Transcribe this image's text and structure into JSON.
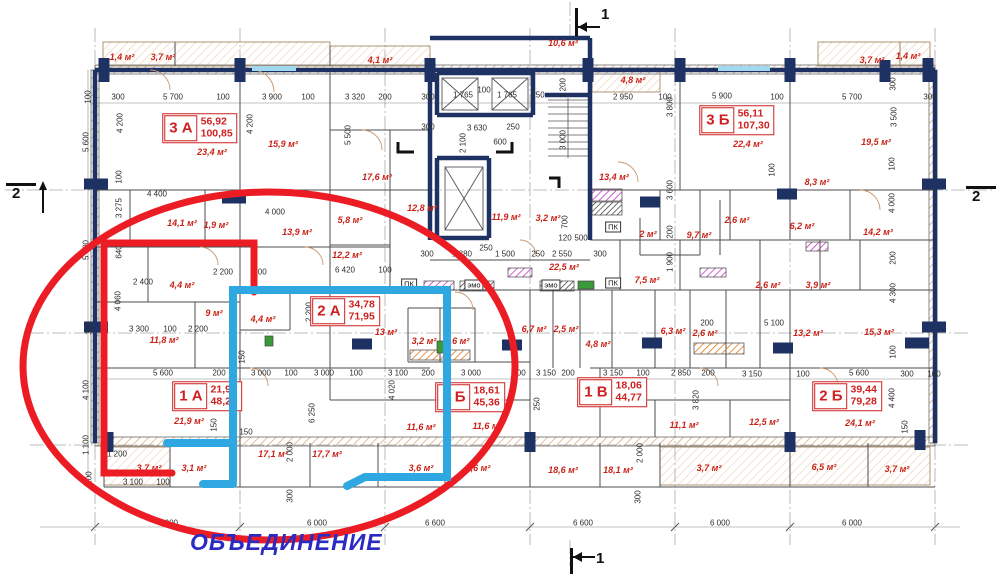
{
  "annotation": {
    "text": "ОБЪЕДИНЕНИЕ"
  },
  "colors": {
    "wall": "#1d3263",
    "area_label": "#c92318",
    "dimension": "#2b2b2b",
    "merge_ellipse": "#ec1c24",
    "merge_outline_red": "#ec1c24",
    "merge_outline_blue": "#2fa8e1",
    "annotation_text": "#2b2bc4",
    "vent_purple": "#c238c2",
    "vent_orange": "#e07818",
    "balcony_hatch": "#d8a36b"
  },
  "section_markers": [
    {
      "label": "1",
      "dir": "top",
      "x": 575,
      "y": 8
    },
    {
      "label": "1",
      "dir": "bottom",
      "x": 570,
      "y": 548
    },
    {
      "label": "2",
      "dir": "left",
      "x": 6,
      "y": 183
    },
    {
      "label": "2",
      "dir": "right",
      "x": 966,
      "y": 186
    }
  ],
  "apartments": [
    {
      "code": "3 А",
      "v1": "56,92",
      "v2": "100,85",
      "x": 200,
      "y": 128
    },
    {
      "code": "3 Б",
      "v1": "56,11",
      "v2": "107,30",
      "x": 737,
      "y": 120
    },
    {
      "code": "2 А",
      "v1": "34,78",
      "v2": "71,95",
      "x": 345,
      "y": 311
    },
    {
      "code": "1 А",
      "v1": "21,92",
      "v2": "48,23",
      "x": 207,
      "y": 396
    },
    {
      "code": "1 Б",
      "v1": "18,61",
      "v2": "45,36",
      "x": 470,
      "y": 397
    },
    {
      "code": "1 В",
      "v1": "18,06",
      "v2": "44,77",
      "x": 612,
      "y": 392
    },
    {
      "code": "2 Б",
      "v1": "39,44",
      "v2": "79,28",
      "x": 847,
      "y": 396
    }
  ],
  "room_areas": [
    {
      "t": "1,4 м²",
      "x": 122,
      "y": 57
    },
    {
      "t": "3,7 м²",
      "x": 163,
      "y": 57
    },
    {
      "t": "4,1 м²",
      "x": 380,
      "y": 60
    },
    {
      "t": "10,6 м²",
      "x": 563,
      "y": 43
    },
    {
      "t": "4,8 м²",
      "x": 633,
      "y": 80
    },
    {
      "t": "3,7 м²",
      "x": 872,
      "y": 60
    },
    {
      "t": "1,4 м²",
      "x": 908,
      "y": 56
    },
    {
      "t": "23,4 м²",
      "x": 212,
      "y": 152
    },
    {
      "t": "15,9 м²",
      "x": 283,
      "y": 144
    },
    {
      "t": "17,6 м²",
      "x": 377,
      "y": 177
    },
    {
      "t": "22,4 м²",
      "x": 748,
      "y": 144
    },
    {
      "t": "19,5 м²",
      "x": 876,
      "y": 142
    },
    {
      "t": "12,8 м²",
      "x": 422,
      "y": 208
    },
    {
      "t": "11,9 м²",
      "x": 506,
      "y": 217
    },
    {
      "t": "3,2 м²",
      "x": 548,
      "y": 218
    },
    {
      "t": "13,4 м²",
      "x": 614,
      "y": 177
    },
    {
      "t": "8,3 м²",
      "x": 817,
      "y": 182
    },
    {
      "t": "6,2 м²",
      "x": 802,
      "y": 226
    },
    {
      "t": "14,1 м²",
      "x": 182,
      "y": 223
    },
    {
      "t": "1,9 м²",
      "x": 216,
      "y": 225
    },
    {
      "t": "13,9 м²",
      "x": 297,
      "y": 232
    },
    {
      "t": "5,8 м²",
      "x": 350,
      "y": 220
    },
    {
      "t": "12,2 м²",
      "x": 347,
      "y": 255
    },
    {
      "t": "22,5 м²",
      "x": 564,
      "y": 267
    },
    {
      "t": "2 м²",
      "x": 648,
      "y": 234
    },
    {
      "t": "9,7 м²",
      "x": 699,
      "y": 235
    },
    {
      "t": "2,6 м²",
      "x": 737,
      "y": 220
    },
    {
      "t": "14,2 м²",
      "x": 878,
      "y": 232
    },
    {
      "t": "4,4 м²",
      "x": 182,
      "y": 285
    },
    {
      "t": "9 м²",
      "x": 214,
      "y": 313
    },
    {
      "t": "11,8 м²",
      "x": 164,
      "y": 340
    },
    {
      "t": "4,4 м²",
      "x": 263,
      "y": 319
    },
    {
      "t": "13 м²",
      "x": 386,
      "y": 332
    },
    {
      "t": "3,2 м²",
      "x": 424,
      "y": 341
    },
    {
      "t": "4,6 м²",
      "x": 457,
      "y": 341
    },
    {
      "t": "6,7 м²",
      "x": 534,
      "y": 329
    },
    {
      "t": "2,5 м²",
      "x": 566,
      "y": 329
    },
    {
      "t": "7,5 м²",
      "x": 647,
      "y": 280
    },
    {
      "t": "2,6 м²",
      "x": 768,
      "y": 285
    },
    {
      "t": "2,6 м²",
      "x": 705,
      "y": 333
    },
    {
      "t": "6,3 м²",
      "x": 673,
      "y": 331
    },
    {
      "t": "4,8 м²",
      "x": 598,
      "y": 344
    },
    {
      "t": "3,9 м²",
      "x": 818,
      "y": 285
    },
    {
      "t": "13,2 м²",
      "x": 808,
      "y": 333
    },
    {
      "t": "15,3 м²",
      "x": 879,
      "y": 332
    },
    {
      "t": "21,9 м²",
      "x": 189,
      "y": 421
    },
    {
      "t": "3,7 м²",
      "x": 149,
      "y": 468
    },
    {
      "t": "3,1 м²",
      "x": 194,
      "y": 468
    },
    {
      "t": "17,1 м²",
      "x": 273,
      "y": 454
    },
    {
      "t": "17,7 м²",
      "x": 327,
      "y": 454
    },
    {
      "t": "11,6 м²",
      "x": 421,
      "y": 427
    },
    {
      "t": "11,6 м²",
      "x": 487,
      "y": 426
    },
    {
      "t": "3,6 м²",
      "x": 421,
      "y": 468
    },
    {
      "t": "3,6 м²",
      "x": 478,
      "y": 468
    },
    {
      "t": "18,6 м²",
      "x": 563,
      "y": 470
    },
    {
      "t": "18,1 м²",
      "x": 618,
      "y": 470
    },
    {
      "t": "11,1 м²",
      "x": 684,
      "y": 425
    },
    {
      "t": "12,5 м²",
      "x": 764,
      "y": 422
    },
    {
      "t": "3,7 м²",
      "x": 709,
      "y": 468
    },
    {
      "t": "24,1 м²",
      "x": 860,
      "y": 423
    },
    {
      "t": "6,5 м²",
      "x": 824,
      "y": 467
    },
    {
      "t": "3,7 м²",
      "x": 897,
      "y": 469
    }
  ],
  "tech_labels": [
    {
      "t": "ПК",
      "x": 409,
      "y": 284
    },
    {
      "t": "ПК",
      "x": 613,
      "y": 227
    },
    {
      "t": "ПК",
      "x": 613,
      "y": 283
    },
    {
      "t": "эмо",
      "x": 474,
      "y": 285
    },
    {
      "t": "эмо",
      "x": 551,
      "y": 285
    }
  ],
  "dimensions": [
    {
      "t": "300",
      "x": 118,
      "y": 97
    },
    {
      "t": "5 700",
      "x": 173,
      "y": 97
    },
    {
      "t": "100",
      "x": 223,
      "y": 97
    },
    {
      "t": "3 900",
      "x": 272,
      "y": 97
    },
    {
      "t": "100",
      "x": 308,
      "y": 97
    },
    {
      "t": "3 320",
      "x": 355,
      "y": 97
    },
    {
      "t": "200",
      "x": 385,
      "y": 97
    },
    {
      "t": "300",
      "x": 428,
      "y": 97
    },
    {
      "t": "1 765",
      "x": 463,
      "y": 95
    },
    {
      "t": "100",
      "x": 484,
      "y": 90
    },
    {
      "t": "1 765",
      "x": 507,
      "y": 95
    },
    {
      "t": "250",
      "x": 538,
      "y": 95
    },
    {
      "t": "2 950",
      "x": 623,
      "y": 97
    },
    {
      "t": "100",
      "x": 665,
      "y": 97
    },
    {
      "t": "5 900",
      "x": 722,
      "y": 96
    },
    {
      "t": "100",
      "x": 777,
      "y": 97
    },
    {
      "t": "5 700",
      "x": 852,
      "y": 97
    },
    {
      "t": "300",
      "x": 930,
      "y": 97
    },
    {
      "t": "300",
      "x": 428,
      "y": 127
    },
    {
      "t": "3 630",
      "x": 477,
      "y": 128
    },
    {
      "t": "250",
      "x": 513,
      "y": 127
    },
    {
      "t": "600",
      "x": 500,
      "y": 142
    },
    {
      "t": "4 400",
      "x": 157,
      "y": 194
    },
    {
      "t": "4 000",
      "x": 275,
      "y": 212
    },
    {
      "t": "2 400",
      "x": 143,
      "y": 282
    },
    {
      "t": "2 200",
      "x": 223,
      "y": 272
    },
    {
      "t": "200",
      "x": 260,
      "y": 272
    },
    {
      "t": "6 420",
      "x": 345,
      "y": 270
    },
    {
      "t": "100",
      "x": 385,
      "y": 270
    },
    {
      "t": "300",
      "x": 427,
      "y": 254
    },
    {
      "t": "1 880",
      "x": 462,
      "y": 254
    },
    {
      "t": "250",
      "x": 486,
      "y": 248
    },
    {
      "t": "1 500",
      "x": 505,
      "y": 254
    },
    {
      "t": "250",
      "x": 538,
      "y": 254
    },
    {
      "t": "2 550",
      "x": 562,
      "y": 254
    },
    {
      "t": "300",
      "x": 600,
      "y": 254
    },
    {
      "t": "120",
      "x": 565,
      "y": 238
    },
    {
      "t": "500",
      "x": 581,
      "y": 238
    },
    {
      "t": "200",
      "x": 707,
      "y": 323
    },
    {
      "t": "5 100",
      "x": 774,
      "y": 323
    },
    {
      "t": "3 300",
      "x": 139,
      "y": 329
    },
    {
      "t": "100",
      "x": 170,
      "y": 329
    },
    {
      "t": "2 200",
      "x": 198,
      "y": 329
    },
    {
      "t": "5 600",
      "x": 163,
      "y": 373
    },
    {
      "t": "200",
      "x": 219,
      "y": 373
    },
    {
      "t": "3 000",
      "x": 261,
      "y": 373
    },
    {
      "t": "100",
      "x": 291,
      "y": 373
    },
    {
      "t": "3 000",
      "x": 324,
      "y": 373
    },
    {
      "t": "100",
      "x": 356,
      "y": 373
    },
    {
      "t": "3 100",
      "x": 398,
      "y": 373
    },
    {
      "t": "200",
      "x": 428,
      "y": 373
    },
    {
      "t": "3 000",
      "x": 471,
      "y": 373
    },
    {
      "t": "100",
      "x": 519,
      "y": 373
    },
    {
      "t": "3 150",
      "x": 546,
      "y": 373
    },
    {
      "t": "200",
      "x": 568,
      "y": 373
    },
    {
      "t": "3 150",
      "x": 613,
      "y": 373
    },
    {
      "t": "100",
      "x": 643,
      "y": 373
    },
    {
      "t": "2 850",
      "x": 681,
      "y": 373
    },
    {
      "t": "200",
      "x": 708,
      "y": 373
    },
    {
      "t": "3 150",
      "x": 752,
      "y": 374
    },
    {
      "t": "100",
      "x": 803,
      "y": 374
    },
    {
      "t": "5 600",
      "x": 859,
      "y": 373
    },
    {
      "t": "300",
      "x": 907,
      "y": 374
    },
    {
      "t": "100",
      "x": 934,
      "y": 374
    },
    {
      "t": "1 200",
      "x": 117,
      "y": 454
    },
    {
      "t": "3 100",
      "x": 133,
      "y": 482
    },
    {
      "t": "100",
      "x": 163,
      "y": 482
    },
    {
      "t": "150",
      "x": 246,
      "y": 432
    },
    {
      "t": "6 000",
      "x": 168,
      "y": 523
    },
    {
      "t": "6 000",
      "x": 317,
      "y": 523
    },
    {
      "t": "6 600",
      "x": 435,
      "y": 523
    },
    {
      "t": "6 600",
      "x": 583,
      "y": 523
    },
    {
      "t": "6 000",
      "x": 720,
      "y": 523
    },
    {
      "t": "6 000",
      "x": 852,
      "y": 523
    },
    {
      "t": "100",
      "x": 88,
      "y": 97,
      "v": 1
    },
    {
      "t": "5 600",
      "x": 86,
      "y": 142,
      "v": 1
    },
    {
      "t": "5 600",
      "x": 86,
      "y": 250,
      "v": 1
    },
    {
      "t": "300",
      "x": 89,
      "y": 328,
      "v": 1
    },
    {
      "t": "4 100",
      "x": 86,
      "y": 390,
      "v": 1
    },
    {
      "t": "1 100",
      "x": 86,
      "y": 445,
      "v": 1
    },
    {
      "t": "100",
      "x": 89,
      "y": 478,
      "v": 1
    },
    {
      "t": "4 200",
      "x": 120,
      "y": 123,
      "v": 1
    },
    {
      "t": "4 200",
      "x": 250,
      "y": 124,
      "v": 1
    },
    {
      "t": "5 500",
      "x": 348,
      "y": 135,
      "v": 1
    },
    {
      "t": "1 200",
      "x": 563,
      "y": 88,
      "v": 1
    },
    {
      "t": "2 100",
      "x": 463,
      "y": 143,
      "v": 1
    },
    {
      "t": "3 000",
      "x": 563,
      "y": 140,
      "v": 1
    },
    {
      "t": "3 800",
      "x": 670,
      "y": 107,
      "v": 1
    },
    {
      "t": "300",
      "x": 893,
      "y": 84,
      "v": 1
    },
    {
      "t": "3 500",
      "x": 894,
      "y": 117,
      "v": 1
    },
    {
      "t": "100",
      "x": 119,
      "y": 177,
      "v": 1
    },
    {
      "t": "3 275",
      "x": 119,
      "y": 208,
      "v": 1
    },
    {
      "t": "640",
      "x": 119,
      "y": 252,
      "v": 1
    },
    {
      "t": "4 060",
      "x": 118,
      "y": 301,
      "v": 1
    },
    {
      "t": "2 200",
      "x": 309,
      "y": 312,
      "v": 1
    },
    {
      "t": "150",
      "x": 242,
      "y": 357,
      "v": 1
    },
    {
      "t": "4 020",
      "x": 392,
      "y": 390,
      "v": 1
    },
    {
      "t": "6 250",
      "x": 312,
      "y": 413,
      "v": 1
    },
    {
      "t": "150",
      "x": 214,
      "y": 425,
      "v": 1
    },
    {
      "t": "2 000",
      "x": 290,
      "y": 452,
      "v": 1
    },
    {
      "t": "300",
      "x": 290,
      "y": 496,
      "v": 1
    },
    {
      "t": "2 000",
      "x": 640,
      "y": 453,
      "v": 1
    },
    {
      "t": "300",
      "x": 638,
      "y": 497,
      "v": 1
    },
    {
      "t": "3 820",
      "x": 696,
      "y": 400,
      "v": 1
    },
    {
      "t": "4 300",
      "x": 893,
      "y": 293,
      "v": 1
    },
    {
      "t": "100",
      "x": 893,
      "y": 352,
      "v": 1
    },
    {
      "t": "4 400",
      "x": 892,
      "y": 398,
      "v": 1
    },
    {
      "t": "150",
      "x": 905,
      "y": 427,
      "v": 1
    },
    {
      "t": "250",
      "x": 537,
      "y": 404,
      "v": 1
    },
    {
      "t": "3 600",
      "x": 670,
      "y": 190,
      "v": 1
    },
    {
      "t": "200",
      "x": 670,
      "y": 232,
      "v": 1
    },
    {
      "t": "1 900",
      "x": 670,
      "y": 262,
      "v": 1
    },
    {
      "t": "700",
      "x": 565,
      "y": 222,
      "v": 1
    },
    {
      "t": "100",
      "x": 892,
      "y": 164,
      "v": 1
    },
    {
      "t": "4 000",
      "x": 892,
      "y": 203,
      "v": 1
    },
    {
      "t": "200",
      "x": 893,
      "y": 258,
      "v": 1
    },
    {
      "t": "100",
      "x": 772,
      "y": 170,
      "v": 1
    }
  ]
}
